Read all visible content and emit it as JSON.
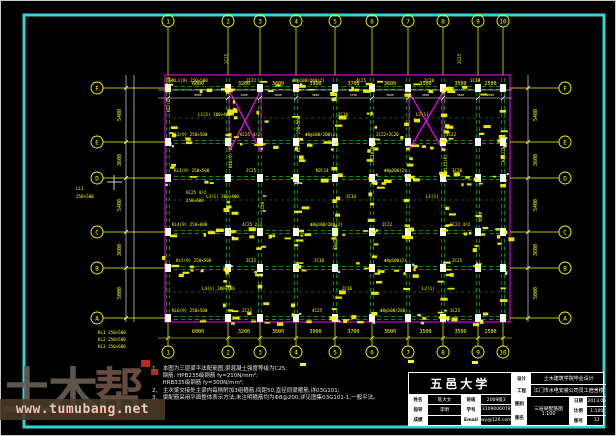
{
  "colors": {
    "frame_cyan": "#2fd6d6",
    "yellow": "#ffff00",
    "green": "#00c400",
    "magenta": "#ff00ff",
    "white": "#ffffff"
  },
  "watermark": {
    "brand_prefix": "土木",
    "brand_suffix": "帮",
    "url": "www.tumubang.net"
  },
  "notes": {
    "lines": [
      "1、 本图为三层梁平法配筋图,梁混凝土强度等级为C25;",
      "      钢筋: HPB235级钢筋 fy=210N/mm²;",
      "      HRB335级钢筋 fy=300N/mm²;",
      "2、 主次梁交接处主梁内每侧附加3组箍筋,间距50,直径同梁箍筋,详03G101;",
      "3、 梁配筋采用平面整体表示方法,未注明箍筋均为Φ8@200,详见图集03G101-1,一般平法。"
    ]
  },
  "titleblock": {
    "university": "五邑大学",
    "info_rows": [
      {
        "l1": "姓名",
        "v1": "陈大文",
        "l2": "班级",
        "v2": "2009级3"
      },
      {
        "l1": "指导",
        "v1": "李明",
        "l2": "学号",
        "v2": "3109006078"
      },
      {
        "l1": "成绩",
        "v1": "",
        "l2": "Email",
        "v2": "wy@126.com"
      }
    ],
    "project_rows": [
      {
        "label": "设计",
        "value": "土木建筑学院毕业设计"
      },
      {
        "label": "工程",
        "value": "江门市水电安装公司员工宿舍楼"
      }
    ],
    "drawing_label_top": "图别",
    "drawing_label_bottom": "图名",
    "drawing_name": "三层梁配筋图 1:100",
    "meta_rows": [
      {
        "label": "日期",
        "value": "2013.06"
      },
      {
        "label": "比例",
        "value": "1:100"
      },
      {
        "label": "图号",
        "value": "12"
      }
    ]
  },
  "plan": {
    "scale": "1:100",
    "column_axes": [
      {
        "label": "1",
        "x": 168
      },
      {
        "label": "2",
        "x": 228
      },
      {
        "label": "3",
        "x": 260
      },
      {
        "label": "4",
        "x": 296
      },
      {
        "label": "5",
        "x": 335
      },
      {
        "label": "6",
        "x": 372
      },
      {
        "label": "7",
        "x": 408
      },
      {
        "label": "8",
        "x": 443
      },
      {
        "label": "9",
        "x": 478
      },
      {
        "label": "10",
        "x": 503
      }
    ],
    "row_axes": [
      {
        "label": "A",
        "y": 318
      },
      {
        "label": "B",
        "y": 268
      },
      {
        "label": "C",
        "y": 232
      },
      {
        "label": "D",
        "y": 178
      },
      {
        "label": "E",
        "y": 142
      },
      {
        "label": "F",
        "y": 88
      }
    ],
    "minor_rows": [
      118,
      200,
      292
    ],
    "outline": {
      "x1": 165,
      "y1": 75,
      "x2": 510,
      "y2": 322
    },
    "top_dims": [
      "6000",
      "3200",
      "3600",
      "3900",
      "3700",
      "3600",
      "3500",
      "3500",
      "2500"
    ],
    "bottom_dims": [
      "6000",
      "3200",
      "3600",
      "3900",
      "3700",
      "3600",
      "3500",
      "3500",
      "2500"
    ],
    "side_dims": [
      "5000",
      "3600",
      "5400",
      "3600",
      "5400"
    ],
    "stair_crosses": [
      {
        "x1": 229,
        "y1": 90,
        "x2": 261,
        "y2": 152
      },
      {
        "x1": 409,
        "y1": 92,
        "x2": 443,
        "y2": 150
      }
    ],
    "annotations": [
      {
        "x": 170,
        "y": 82,
        "t": "WKL1(9) 250×500"
      },
      {
        "x": 246,
        "y": 82,
        "t": "2C22"
      },
      {
        "x": 292,
        "y": 82,
        "t": "Φ8@100/200(2)"
      },
      {
        "x": 356,
        "y": 82,
        "t": "4C25"
      },
      {
        "x": 424,
        "y": 82,
        "t": "2C20"
      },
      {
        "x": 470,
        "y": 82,
        "t": "3C18"
      },
      {
        "x": 172,
        "y": 136,
        "t": "KL2(9) 250×500"
      },
      {
        "x": 240,
        "y": 136,
        "t": "6C25 4/2"
      },
      {
        "x": 305,
        "y": 136,
        "t": "Φ8@100/200(2)"
      },
      {
        "x": 376,
        "y": 136,
        "t": "2C22+2C20"
      },
      {
        "x": 446,
        "y": 136,
        "t": "4C22"
      },
      {
        "x": 174,
        "y": 172,
        "t": "KL3(9) 250×500"
      },
      {
        "x": 246,
        "y": 172,
        "t": "2C25"
      },
      {
        "x": 316,
        "y": 172,
        "t": "N2C14"
      },
      {
        "x": 384,
        "y": 172,
        "t": "Φ8@200(2)"
      },
      {
        "x": 452,
        "y": 172,
        "t": "3C20"
      },
      {
        "x": 172,
        "y": 226,
        "t": "KL4(9) 250×600"
      },
      {
        "x": 242,
        "y": 226,
        "t": "4C25 2/2"
      },
      {
        "x": 310,
        "y": 226,
        "t": "Φ8@100/200(2)"
      },
      {
        "x": 382,
        "y": 226,
        "t": "2C22"
      },
      {
        "x": 450,
        "y": 226,
        "t": "6C22 4/2"
      },
      {
        "x": 176,
        "y": 262,
        "t": "KL5(9) 250×500"
      },
      {
        "x": 246,
        "y": 262,
        "t": "3C22"
      },
      {
        "x": 314,
        "y": 262,
        "t": "2C16"
      },
      {
        "x": 384,
        "y": 262,
        "t": "Φ8@100(2)"
      },
      {
        "x": 452,
        "y": 262,
        "t": "2C25"
      },
      {
        "x": 172,
        "y": 312,
        "t": "KL6(9) 250×500"
      },
      {
        "x": 242,
        "y": 312,
        "t": "2C22"
      },
      {
        "x": 312,
        "y": 312,
        "t": "4C25"
      },
      {
        "x": 380,
        "y": 312,
        "t": "Φ8@100/200"
      },
      {
        "x": 450,
        "y": 312,
        "t": "3C25"
      },
      {
        "x": 198,
        "y": 116,
        "t": "L1(1) 200×400"
      },
      {
        "x": 338,
        "y": 116,
        "t": "2C16"
      },
      {
        "x": 416,
        "y": 116,
        "t": "L2(1)"
      },
      {
        "x": 206,
        "y": 198,
        "t": "L3(1) 200×400"
      },
      {
        "x": 346,
        "y": 198,
        "t": "2C14"
      },
      {
        "x": 426,
        "y": 198,
        "t": "L1(1)"
      },
      {
        "x": 202,
        "y": 290,
        "t": "L4(1) 200×400"
      },
      {
        "x": 342,
        "y": 290,
        "t": "2C16"
      },
      {
        "x": 422,
        "y": 290,
        "t": "L2(1)"
      },
      {
        "x": 170,
        "y": 112,
        "t": "KL7(6) 250×500",
        "r": 1
      },
      {
        "x": 232,
        "y": 168,
        "t": "KL8(6) 250×500",
        "r": 1
      },
      {
        "x": 264,
        "y": 212,
        "t": "2C20",
        "r": 1
      },
      {
        "x": 300,
        "y": 152,
        "t": "KL9(6) 250×500",
        "r": 1
      },
      {
        "x": 337,
        "y": 250,
        "t": "Φ8@100/200",
        "r": 1
      },
      {
        "x": 374,
        "y": 162,
        "t": "KL10(6)",
        "r": 1
      },
      {
        "x": 410,
        "y": 242,
        "t": "2C22",
        "r": 1
      },
      {
        "x": 447,
        "y": 172,
        "t": "KL11(6)",
        "r": 1
      },
      {
        "x": 482,
        "y": 222,
        "t": "3C20",
        "r": 1
      },
      {
        "x": 505,
        "y": 162,
        "t": "KL12(6)",
        "r": 1
      },
      {
        "x": 186,
        "y": 194,
        "t": "6C25 4/2"
      },
      {
        "x": 186,
        "y": 202,
        "t": "250×600"
      },
      {
        "x": 76,
        "y": 190,
        "t": "LL1"
      },
      {
        "x": 76,
        "y": 198,
        "t": "250×500"
      },
      {
        "x": 98,
        "y": 334,
        "t": "KL1 250×500"
      },
      {
        "x": 98,
        "y": 341,
        "t": "KL2 250×500"
      },
      {
        "x": 98,
        "y": 348,
        "t": "KL3 250×600"
      },
      {
        "x": 228,
        "y": 64,
        "t": "2C25",
        "r": 1
      },
      {
        "x": 461,
        "y": 64,
        "t": "2C25",
        "r": 1
      }
    ]
  }
}
